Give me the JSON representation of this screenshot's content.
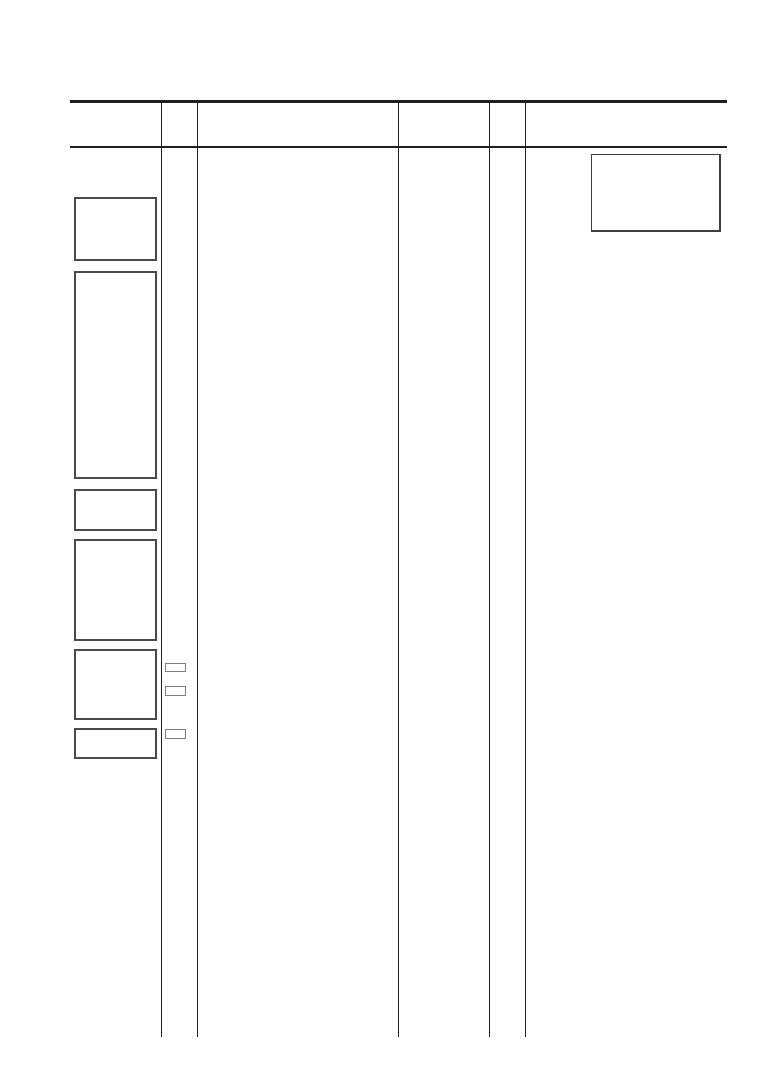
{
  "page": {
    "width": 761,
    "height": 1076,
    "background": "#ffffff"
  },
  "colors": {
    "page_bg": "#ffffff",
    "rule": "#1f1f1f",
    "box_border": "#4a4a4a",
    "checkbox_border": "#7d7d7d",
    "note_border": "#3d3d3d"
  },
  "header_rules": {
    "thick": {
      "x": 70,
      "y": 100,
      "w": 657,
      "h": 3
    },
    "thin": {
      "x": 70,
      "y": 146,
      "w": 657,
      "h": 1.5
    }
  },
  "column_dividers": [
    {
      "x": 161,
      "y": 101,
      "w": 1.2,
      "h": 936
    },
    {
      "x": 197,
      "y": 101,
      "w": 1.2,
      "h": 936
    },
    {
      "x": 398,
      "y": 101,
      "w": 1.2,
      "h": 936
    },
    {
      "x": 489,
      "y": 101,
      "w": 1.2,
      "h": 936
    },
    {
      "x": 525,
      "y": 101,
      "w": 1.2,
      "h": 936
    }
  ],
  "right_note_box": {
    "x": 591,
    "y": 154,
    "w": 130,
    "h": 78
  },
  "left_boxes": [
    {
      "x": 74,
      "y": 197,
      "w": 83,
      "h": 64
    },
    {
      "x": 74,
      "y": 271,
      "w": 83,
      "h": 208
    },
    {
      "x": 74,
      "y": 489,
      "w": 83,
      "h": 42
    },
    {
      "x": 74,
      "y": 539,
      "w": 83,
      "h": 102
    },
    {
      "x": 74,
      "y": 649,
      "w": 83,
      "h": 71
    },
    {
      "x": 74,
      "y": 728,
      "w": 83,
      "h": 31
    }
  ],
  "checkboxes": [
    {
      "x": 165,
      "y": 663,
      "w": 21,
      "h": 9
    },
    {
      "x": 165,
      "y": 686,
      "w": 21,
      "h": 10
    },
    {
      "x": 165,
      "y": 729,
      "w": 21,
      "h": 10
    }
  ]
}
